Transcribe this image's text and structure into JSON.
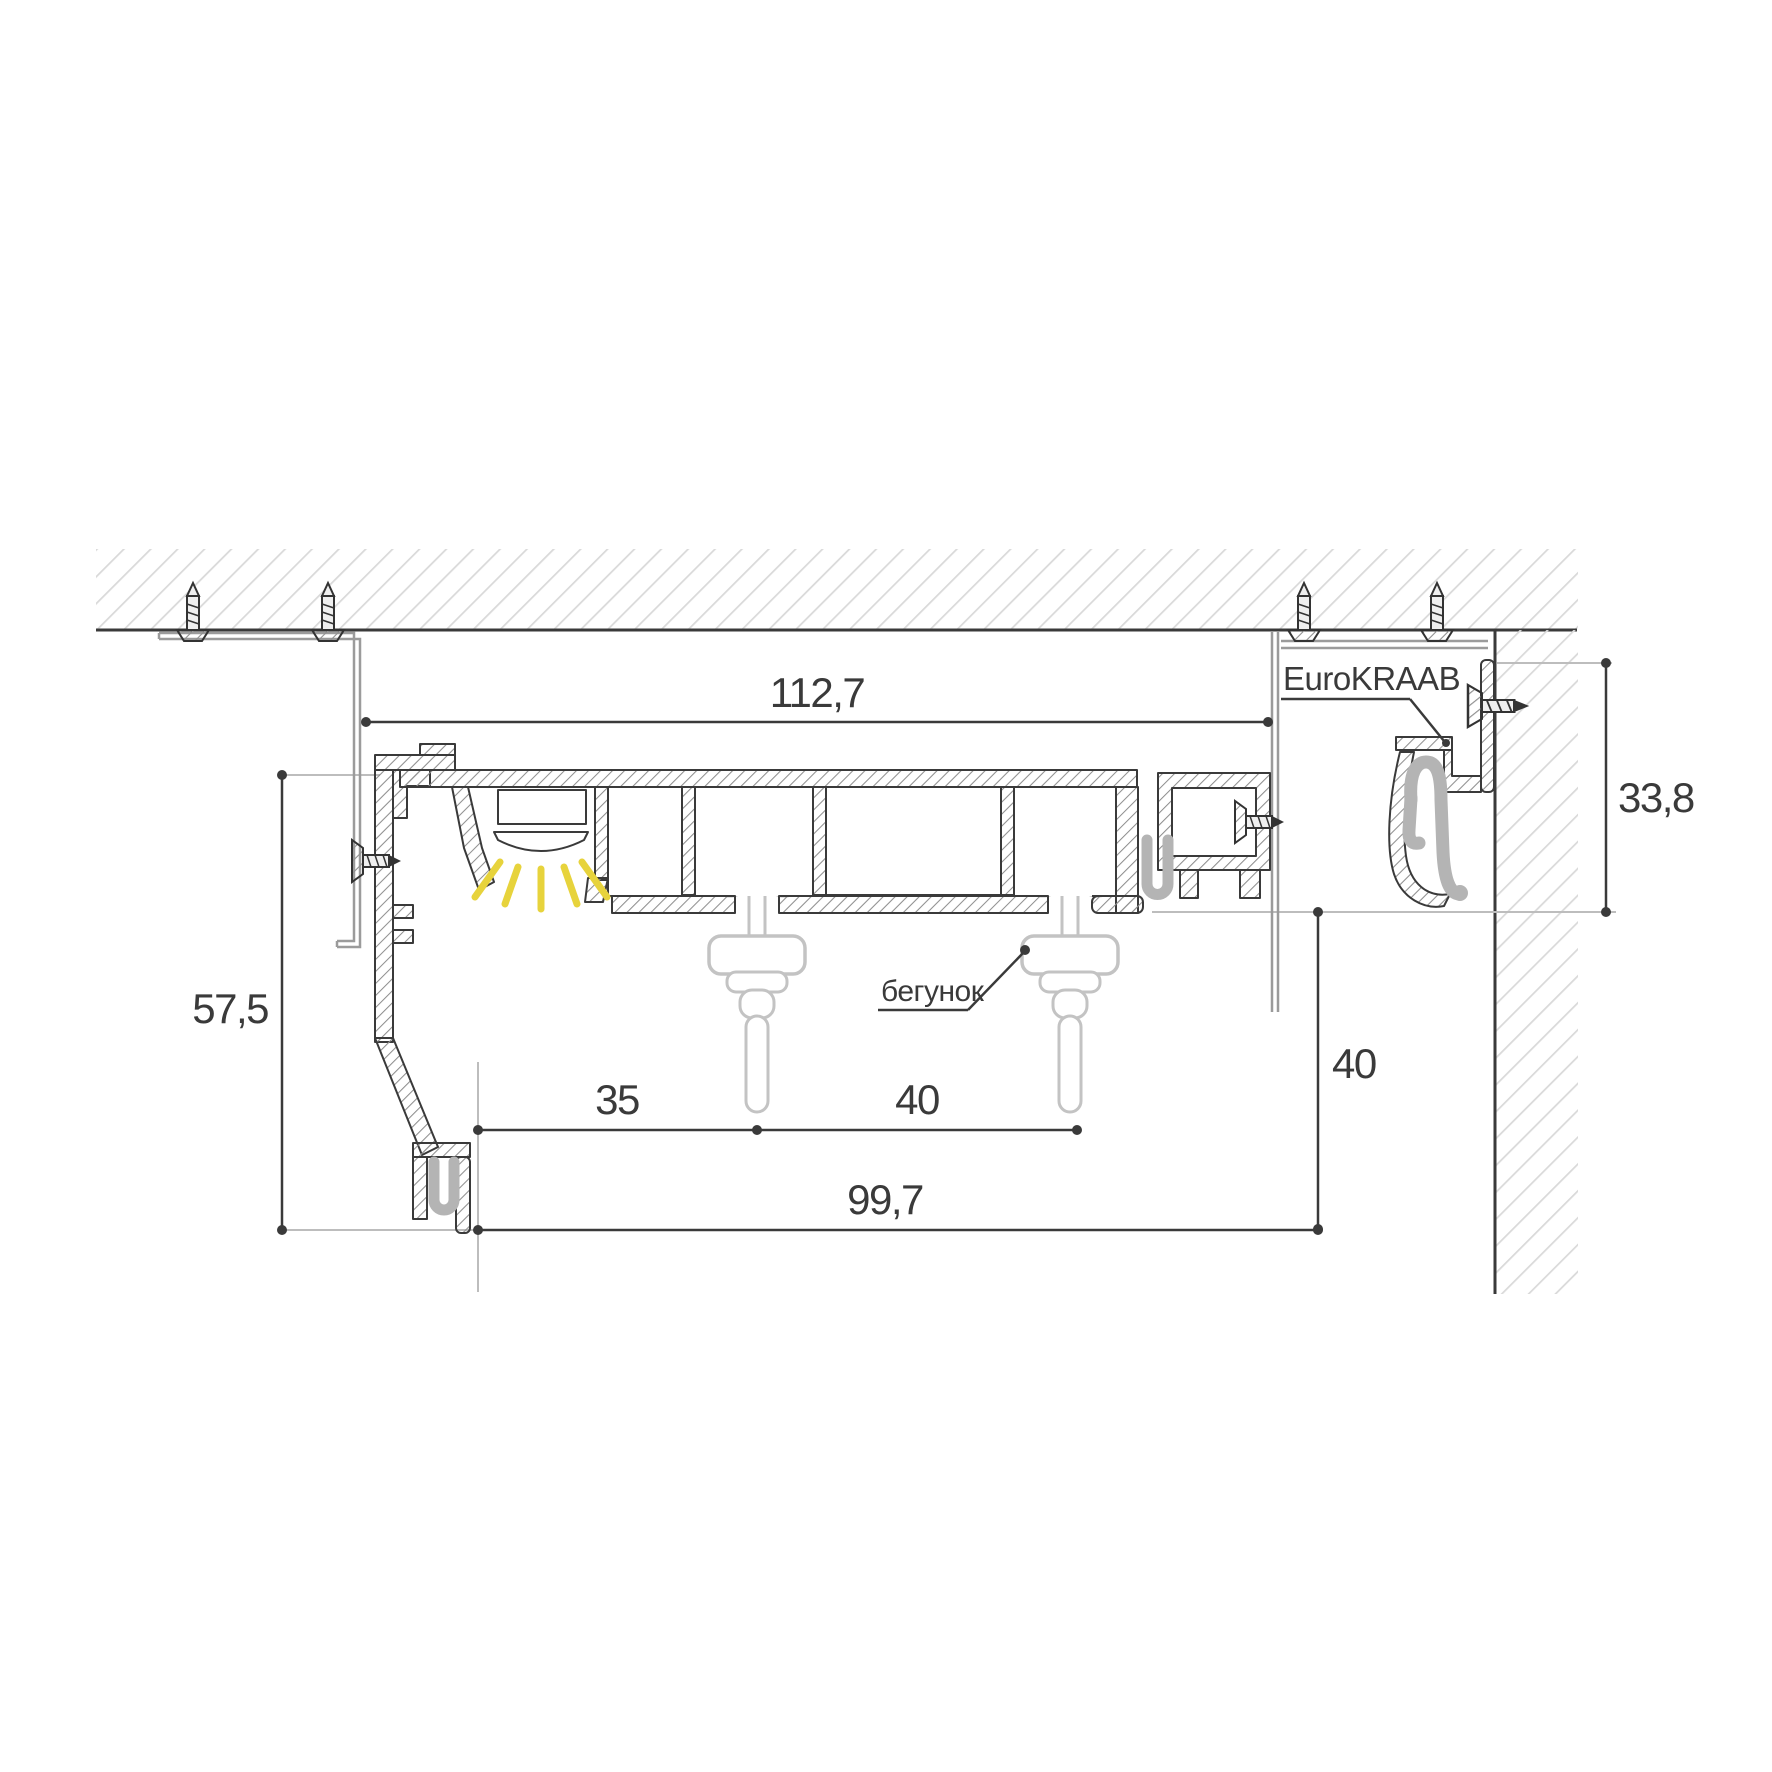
{
  "drawing": {
    "brand_label": "EuroKRAAB",
    "runner_label": "бегунок",
    "dims": {
      "track_width_top": "112,7",
      "left_height": "57,5",
      "led_to_runner": "35",
      "runner_spacing": "40",
      "bottom_width": "99,7",
      "wall_drop": "40",
      "bracket_height": "33,8"
    },
    "colors": {
      "line": "#3a3a3a",
      "hatch_light": "#d9d9d9",
      "hatch_metal": "#8f8f8f",
      "bracket_gray": "#9b9b9b",
      "spring_gray": "#b4b4b4",
      "runner_gray": "#c3c3c3",
      "led_yellow": "#e7d33c"
    }
  }
}
